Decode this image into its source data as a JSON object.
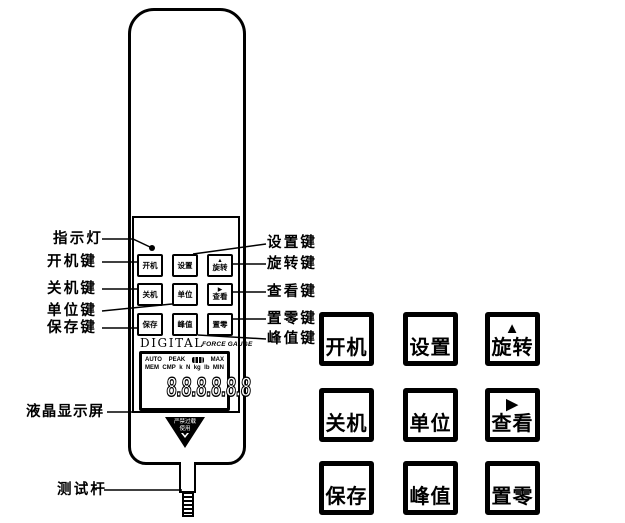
{
  "figure": {
    "left_labels": {
      "indicator": "指示灯",
      "power_on": "开机键",
      "power_off": "关机键",
      "unit": "单位键",
      "save": "保存键",
      "lcd": "液晶显示屏",
      "test_rod": "测试杆"
    },
    "right_labels": {
      "set": "设置键",
      "rotate": "旋转键",
      "view": "查看键",
      "zero": "置零键",
      "peak": "峰值键"
    }
  },
  "device": {
    "brand": "DIGITAL",
    "product": "FORCE GAUGE",
    "lcd": {
      "auto": "AUTO",
      "peak": "PEAK",
      "max": "MAX",
      "mem": "MEM",
      "cmp": "CMP",
      "unit_k": "k",
      "unit_n": "N",
      "unit_kg": "kg",
      "unit_lb": "lb",
      "min": "MIN",
      "digits": "8.8.8.8.8.8"
    },
    "warning": {
      "line1": "严禁过载",
      "line2": "使用"
    }
  },
  "keys": {
    "power_on": "开机",
    "set": "设置",
    "rotate": "旋转",
    "power_off": "关机",
    "unit": "单位",
    "view": "查看",
    "save": "保存",
    "peak": "峰值",
    "zero": "置零",
    "rotate_icon": "▲",
    "view_icon": "▶"
  },
  "colors": {
    "ink": "#000000",
    "background": "#ffffff"
  }
}
